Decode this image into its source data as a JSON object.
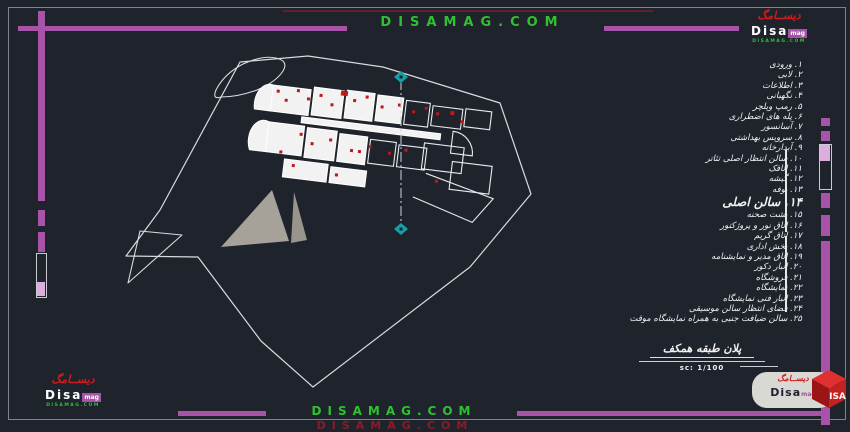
{
  "watermarks": {
    "top": "DISAMAG.COM",
    "bottom": "DISAMAG.COM",
    "bottom_shadow": "DISAMAG.COM"
  },
  "brand": {
    "persian": "ديســامگ",
    "name": "Disa",
    "suffix": "mag",
    "domain": "DISAMAG.COM",
    "cube": "ISA"
  },
  "legend": {
    "items": [
      {
        "num": "۱",
        "label": "ورودی"
      },
      {
        "num": "۲",
        "label": "لابی"
      },
      {
        "num": "۳",
        "label": "اطلاعات"
      },
      {
        "num": "۴",
        "label": "نگهبانی"
      },
      {
        "num": "۵",
        "label": "رمپ ویلچر"
      },
      {
        "num": "۶",
        "label": "پله های اضطراری"
      },
      {
        "num": "۷",
        "label": "آسانسور"
      },
      {
        "num": "۸",
        "label": "سرویس بهداشتی"
      },
      {
        "num": "۹",
        "label": "آبدارخانه"
      },
      {
        "num": "۱۰",
        "label": "سالن انتظار اصلی تئاتر"
      },
      {
        "num": "۱۱",
        "label": "اتاقک"
      },
      {
        "num": "۱۲",
        "label": "گیشه"
      },
      {
        "num": "۱۳",
        "label": "بوفه"
      },
      {
        "num": "۱۴",
        "label": "سالن اصلی",
        "big": true
      },
      {
        "num": "۱۵",
        "label": "پشت صحنه"
      },
      {
        "num": "۱۶",
        "label": "اتاق نور و پروژکتور"
      },
      {
        "num": "۱۷",
        "label": "اتاق گریم"
      },
      {
        "num": "۱۸",
        "label": "بخش اداری"
      },
      {
        "num": "۱۹",
        "label": "اتاق مدیر و نمایشنامه"
      },
      {
        "num": "۲۰",
        "label": "انبار دکور"
      },
      {
        "num": "۲۱",
        "label": "فروشگاه"
      },
      {
        "num": "۲۲",
        "label": "نمایشگاه"
      },
      {
        "num": "۲۳",
        "label": "انبار فنی نمایشگاه"
      },
      {
        "num": "۲۴",
        "label": "فضای انتظار سالن موسیقی"
      },
      {
        "num": "۲۵",
        "label": "سالن ضیافت جنبی به همراه نمایشگاه موقت"
      }
    ]
  },
  "titleblock": {
    "title": "پلان طبقه همکف",
    "scale": "sc: 1/100"
  },
  "colors": {
    "background": "#1e232c",
    "accent_purple": "#a853a8",
    "accent_purple_light": "#dcaedc",
    "watermark_green": "#2fc12f",
    "brand_red": "#cf1d1d",
    "section_teal": "#17a0a5",
    "door_mark_red": "#c01818",
    "drawing_white": "#e4e6e9"
  }
}
